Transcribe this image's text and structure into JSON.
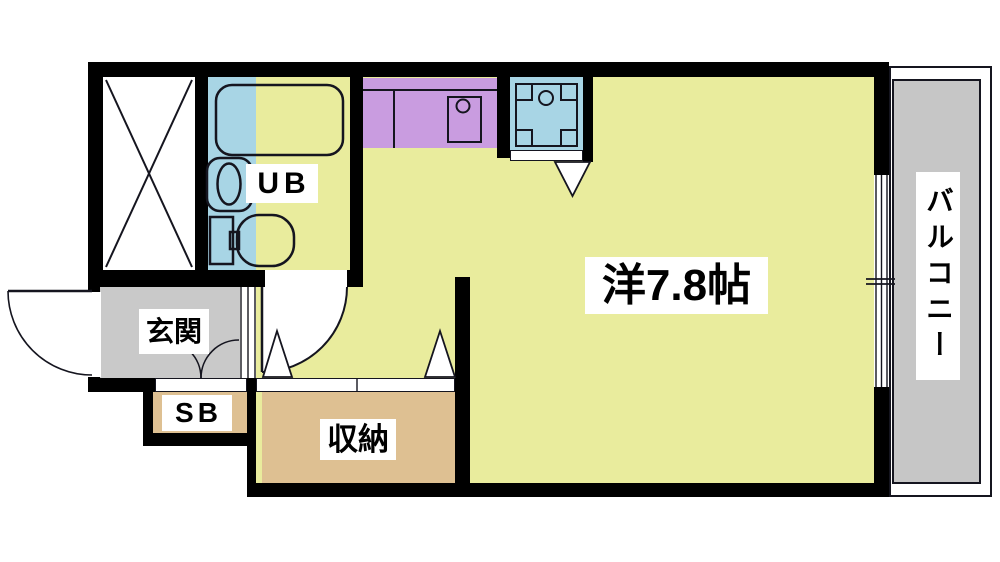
{
  "plan_title": "apartment-floor-plan",
  "rooms": {
    "main_room": {
      "label": "洋7.8帖",
      "type": "western-style-room",
      "size_tatami": "7.8"
    },
    "balcony": {
      "label": "バルコニー"
    },
    "entrance": {
      "label": "玄関"
    },
    "shoe_box": {
      "label": "SB"
    },
    "storage": {
      "label": "収納"
    },
    "unit_bath": {
      "label": "UB"
    }
  },
  "icons": [
    "bathtub-icon",
    "washbasin-icon",
    "toilet-icon",
    "kitchen-sink-icon",
    "faucet-icon",
    "washing-machine-pan-icon",
    "door-swing-arc-icon",
    "double-door-swing-icon",
    "folding-door-triangle-icon",
    "sliding-window-icon",
    "void-x-box-icon"
  ],
  "colors": {
    "wall": "#000000",
    "line": "#15151f",
    "main_room": "#e9ec9d",
    "kitchen_counter": "#c99ce0",
    "unit_bath": "#a8d5e5",
    "entrance": "#c9c9c9",
    "balcony": "#c6c6c6",
    "storage": "#dec092",
    "background": "#ffffff"
  }
}
